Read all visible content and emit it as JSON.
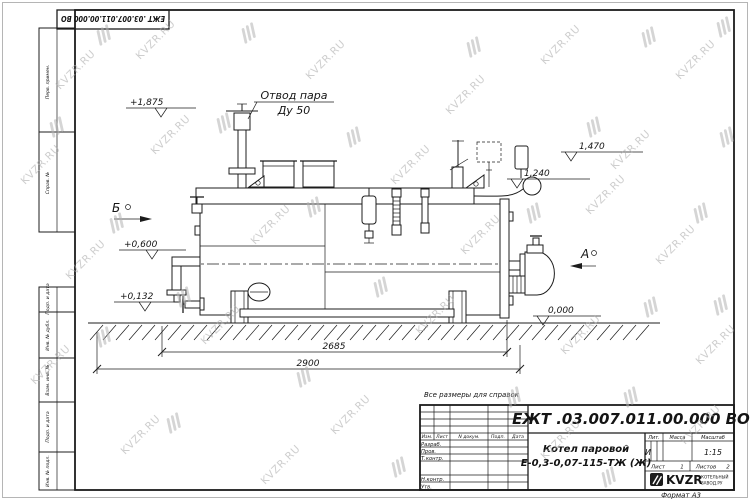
{
  "watermark": {
    "text": "KVZR.RU"
  },
  "stamp_top": "ЕЖТ .03.007.011.00.000  ВО",
  "margin_labels": {
    "perv": "Перв. примен.",
    "sprav": "Справ. №",
    "podp1": "Подп. и дата",
    "inv_dubl": "Инв. № дубл.",
    "vzam": "Взам. инв. №",
    "podp2": "Подп. и дата",
    "inv_podl": "Инв. № подл."
  },
  "drawing": {
    "annotation_line1": "Отвод пара",
    "annotation_line2": "Ду 50",
    "view_a": "А",
    "view_b": "Б",
    "elev_steam": "+1,875",
    "elev_right_top": "1,470",
    "elev_right_mid": "1,240",
    "elev_water": "+0,600",
    "elev_low": "+0,132",
    "elev_zero": "0,000",
    "dim_inner": "2685",
    "dim_outer": "2900"
  },
  "note": "Все размеры для справок",
  "title_block": {
    "doc_number": "ЕЖТ .03.007.011.00.000  ВО",
    "product_name": "Котел паровой",
    "product_model": "Е-0,3-0,07-115-ТЖ (Ж)",
    "col_izm": "Изм.",
    "col_list": "Лист",
    "col_doc": "N докум.",
    "col_podp": "Подп.",
    "col_data": "Дата",
    "row_razrab": "Разраб.",
    "row_prov": "Пров.",
    "row_tkontr": "Т.контр.",
    "row_nkontr": "Н.контр.",
    "row_utv": "Утв.",
    "lit_label": "Лит.",
    "lit_value": "И",
    "massa_label": "Масса",
    "scale_label": "Масштаб",
    "scale_value": "1:15",
    "sheet_label": "Лист",
    "sheet_value": "1",
    "sheets_label": "Листов",
    "sheets_value": "2",
    "logo_text": "KVZR",
    "logo_sub1": "КОТЕЛЬНЫЙ",
    "logo_sub2": "ЗАВОД.РУ"
  },
  "format_note": "Формат А3"
}
